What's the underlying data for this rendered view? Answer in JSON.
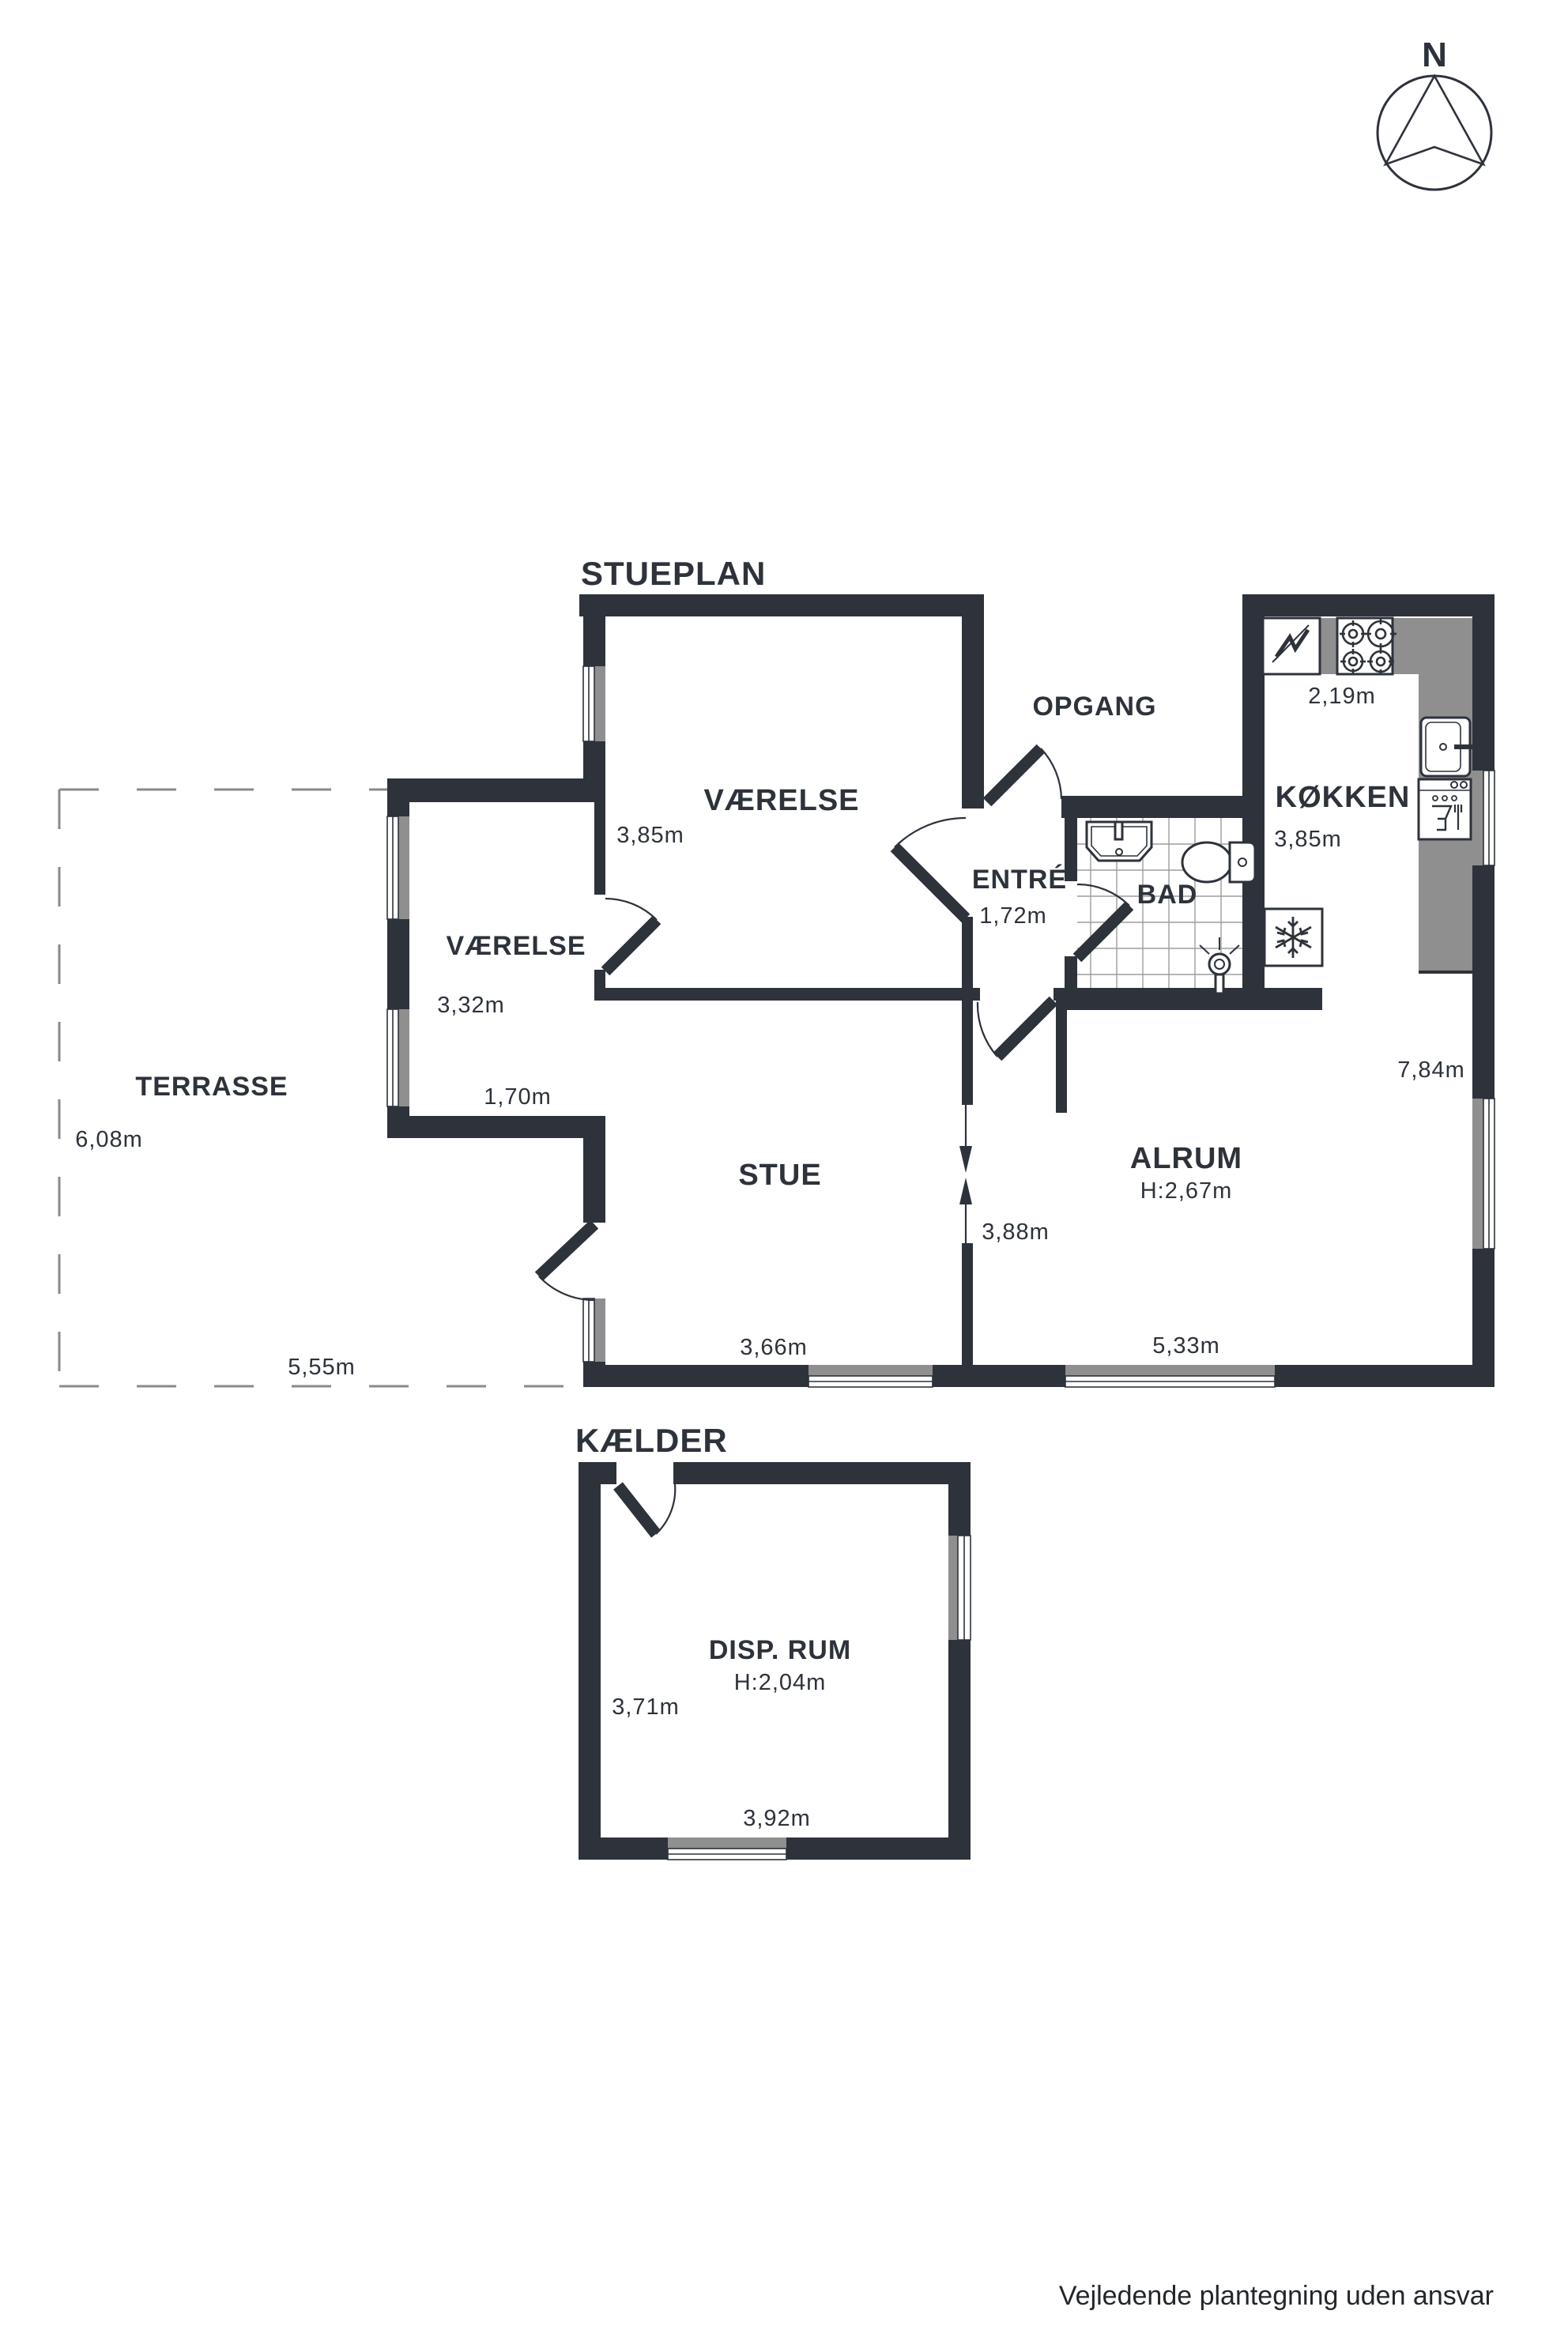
{
  "page": {
    "floor_title": "STUEPLAN",
    "basement_title": "KÆLDER",
    "north_label": "N",
    "disclaimer": "Vejledende plantegning uden ansvar"
  },
  "colors": {
    "wall": "#2d323b",
    "counter_gray": "#8f8f8f",
    "text": "#2d323b"
  },
  "rooms": {
    "vaerelse_top": {
      "name": "VÆRELSE",
      "width_dim": "3,85m"
    },
    "vaerelse_annex": {
      "name": "VÆRELSE",
      "depth_dim": "3,32m",
      "width_dim": "1,70m"
    },
    "opgang": {
      "name": "OPGANG"
    },
    "koekken": {
      "name": "KØKKEN",
      "width_dim": "2,19m",
      "depth_dim": "3,85m"
    },
    "entre": {
      "name": "ENTRÉ",
      "width_dim": "1,72m"
    },
    "bad": {
      "name": "BAD"
    },
    "terrasse": {
      "name": "TERRASSE",
      "depth_dim": "6,08m",
      "width_dim": "5,55m"
    },
    "stue": {
      "name": "STUE",
      "width_dim": "3,66m"
    },
    "alrum": {
      "name": "ALRUM",
      "ceiling_height": "H:2,67m",
      "opening_dim": "3,88m",
      "width_dim": "5,33m",
      "side_dim": "7,84m"
    },
    "disp_rum": {
      "name": "DISP. RUM",
      "ceiling_height": "H:2,04m",
      "depth_dim": "3,71m",
      "width_dim": "3,92m"
    }
  }
}
